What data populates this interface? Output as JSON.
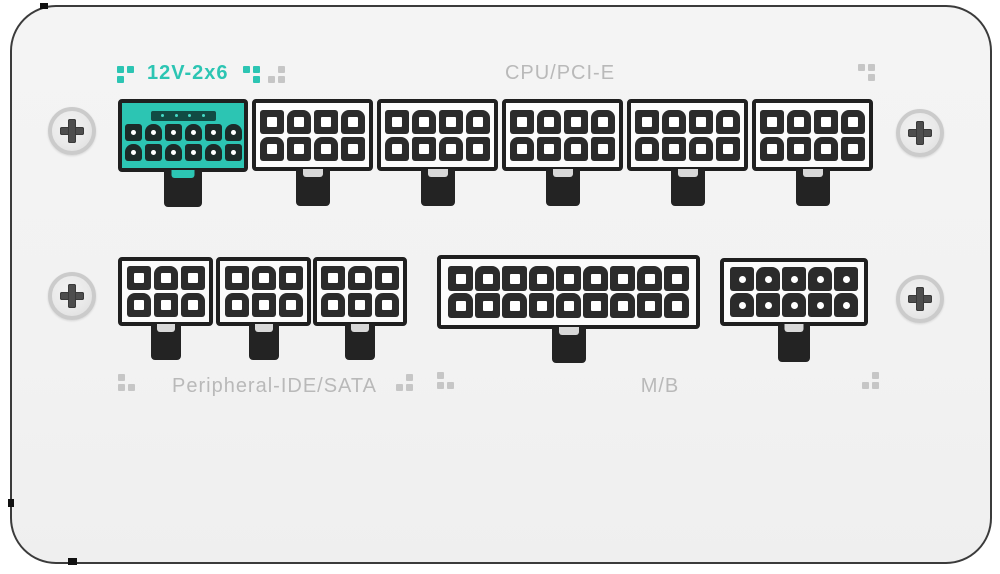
{
  "panel": {
    "type": "psu-modular-connector-panel",
    "background_color": "#f3f3f3",
    "outline_color": "#3b3b3b"
  },
  "colors": {
    "teal": "#2cc5b3",
    "teal_sense_bar": "#114b44",
    "label_gray": "#b9b9b9",
    "motif_gray": "#c6c6c6",
    "connector_border": "#1f1f1f",
    "pin_black": "#2b2b2b",
    "hole_white": "#ffffff",
    "tab_black": "#232323",
    "tab_notch_gray": "#d8d8d8"
  },
  "labels": {
    "twelve_v": "12V-2x6",
    "cpu_pcie": "CPU/PCI-E",
    "peripheral": "Peripheral-IDE/SATA",
    "mb": "M/B"
  },
  "connectors": [
    {
      "id": "connector-12v-2x6",
      "group": "12V-2x6",
      "x": 118,
      "y": 99,
      "w": 130,
      "h": 73,
      "rows": 2,
      "cols": 6,
      "pin": 17,
      "gap": 3,
      "hole": "dot",
      "hole_size": 5,
      "style": "teal",
      "sense_pins": 4,
      "tab_w": 38,
      "tab_h": 37,
      "notch": "teal"
    },
    {
      "id": "connector-cpu-pcie-1",
      "group": "CPU/PCI-E",
      "x": 252,
      "y": 99,
      "w": 121,
      "h": 72,
      "rows": 2,
      "cols": 4,
      "pin": 24,
      "gap": 3,
      "hole": "square",
      "hole_size": 10,
      "style": "white",
      "sense_pins": 0,
      "tab_w": 34,
      "tab_h": 37,
      "notch": "gray"
    },
    {
      "id": "connector-cpu-pcie-2",
      "group": "CPU/PCI-E",
      "x": 377,
      "y": 99,
      "w": 121,
      "h": 72,
      "rows": 2,
      "cols": 4,
      "pin": 24,
      "gap": 3,
      "hole": "square",
      "hole_size": 10,
      "style": "white",
      "sense_pins": 0,
      "tab_w": 34,
      "tab_h": 37,
      "notch": "gray"
    },
    {
      "id": "connector-cpu-pcie-3",
      "group": "CPU/PCI-E",
      "x": 502,
      "y": 99,
      "w": 121,
      "h": 72,
      "rows": 2,
      "cols": 4,
      "pin": 24,
      "gap": 3,
      "hole": "square",
      "hole_size": 10,
      "style": "white",
      "sense_pins": 0,
      "tab_w": 34,
      "tab_h": 37,
      "notch": "gray"
    },
    {
      "id": "connector-cpu-pcie-4",
      "group": "CPU/PCI-E",
      "x": 627,
      "y": 99,
      "w": 121,
      "h": 72,
      "rows": 2,
      "cols": 4,
      "pin": 24,
      "gap": 3,
      "hole": "square",
      "hole_size": 10,
      "style": "white",
      "sense_pins": 0,
      "tab_w": 34,
      "tab_h": 37,
      "notch": "gray"
    },
    {
      "id": "connector-cpu-pcie-5",
      "group": "CPU/PCI-E",
      "x": 752,
      "y": 99,
      "w": 121,
      "h": 72,
      "rows": 2,
      "cols": 4,
      "pin": 24,
      "gap": 3,
      "hole": "square",
      "hole_size": 10,
      "style": "white",
      "sense_pins": 0,
      "tab_w": 34,
      "tab_h": 37,
      "notch": "gray"
    },
    {
      "id": "connector-peripheral-1",
      "group": "Peripheral-IDE/SATA",
      "x": 118,
      "y": 257,
      "w": 95,
      "h": 69,
      "rows": 2,
      "cols": 3,
      "pin": 24,
      "gap": 3,
      "hole": "square",
      "hole_size": 10,
      "style": "white",
      "sense_pins": 0,
      "tab_w": 30,
      "tab_h": 36,
      "notch": "gray"
    },
    {
      "id": "connector-peripheral-2",
      "group": "Peripheral-IDE/SATA",
      "x": 216,
      "y": 257,
      "w": 95,
      "h": 69,
      "rows": 2,
      "cols": 3,
      "pin": 24,
      "gap": 3,
      "hole": "square",
      "hole_size": 10,
      "style": "white",
      "sense_pins": 0,
      "tab_w": 30,
      "tab_h": 36,
      "notch": "gray"
    },
    {
      "id": "connector-peripheral-3",
      "group": "Peripheral-IDE/SATA",
      "x": 313,
      "y": 257,
      "w": 94,
      "h": 69,
      "rows": 2,
      "cols": 3,
      "pin": 24,
      "gap": 3,
      "hole": "square",
      "hole_size": 10,
      "style": "white",
      "sense_pins": 0,
      "tab_w": 30,
      "tab_h": 36,
      "notch": "gray"
    },
    {
      "id": "connector-mb-18pin",
      "group": "M/B",
      "x": 437,
      "y": 255,
      "w": 263,
      "h": 74,
      "rows": 2,
      "cols": 9,
      "pin": 25,
      "gap": 2,
      "hole": "square",
      "hole_size": 10,
      "style": "white",
      "sense_pins": 0,
      "tab_w": 34,
      "tab_h": 36,
      "notch": "gray"
    },
    {
      "id": "connector-mb-10pin",
      "group": "M/B",
      "x": 720,
      "y": 258,
      "w": 148,
      "h": 68,
      "rows": 2,
      "cols": 5,
      "pin": 24,
      "gap": 2,
      "hole": "dot",
      "hole_size": 7,
      "style": "white",
      "sense_pins": 0,
      "tab_w": 32,
      "tab_h": 38,
      "notch": "gray"
    }
  ],
  "screws": [
    {
      "id": "screw-top-left",
      "cx": 72,
      "cy": 131
    },
    {
      "id": "screw-top-right",
      "cx": 920,
      "cy": 133
    },
    {
      "id": "screw-bottom-left",
      "cx": 72,
      "cy": 296
    },
    {
      "id": "screw-bottom-right",
      "cx": 920,
      "cy": 299
    }
  ],
  "dot_motifs": [
    {
      "x": 117,
      "y": 66,
      "color": "teal",
      "cells": [
        "tl",
        "tr",
        "bl"
      ]
    },
    {
      "x": 243,
      "y": 66,
      "color": "teal",
      "cells": [
        "tl",
        "tr",
        "br"
      ]
    },
    {
      "x": 268,
      "y": 66,
      "color": "gray",
      "cells": [
        "tr",
        "bl",
        "br"
      ]
    },
    {
      "x": 858,
      "y": 64,
      "color": "gray",
      "cells": [
        "tl",
        "tr",
        "br"
      ]
    },
    {
      "x": 118,
      "y": 374,
      "color": "gray",
      "cells": [
        "tl",
        "bl",
        "br"
      ]
    },
    {
      "x": 396,
      "y": 374,
      "color": "gray",
      "cells": [
        "tr",
        "bl",
        "br"
      ]
    },
    {
      "x": 437,
      "y": 372,
      "color": "gray",
      "cells": [
        "tl",
        "bl",
        "br"
      ]
    },
    {
      "x": 862,
      "y": 372,
      "color": "gray",
      "cells": [
        "tr",
        "bl",
        "br"
      ]
    }
  ],
  "panel_notches": [
    {
      "x": 40,
      "y": 3,
      "w": 8,
      "h": 6
    },
    {
      "x": 8,
      "y": 499,
      "w": 6,
      "h": 8
    },
    {
      "x": 68,
      "y": 558,
      "w": 9,
      "h": 7
    }
  ]
}
